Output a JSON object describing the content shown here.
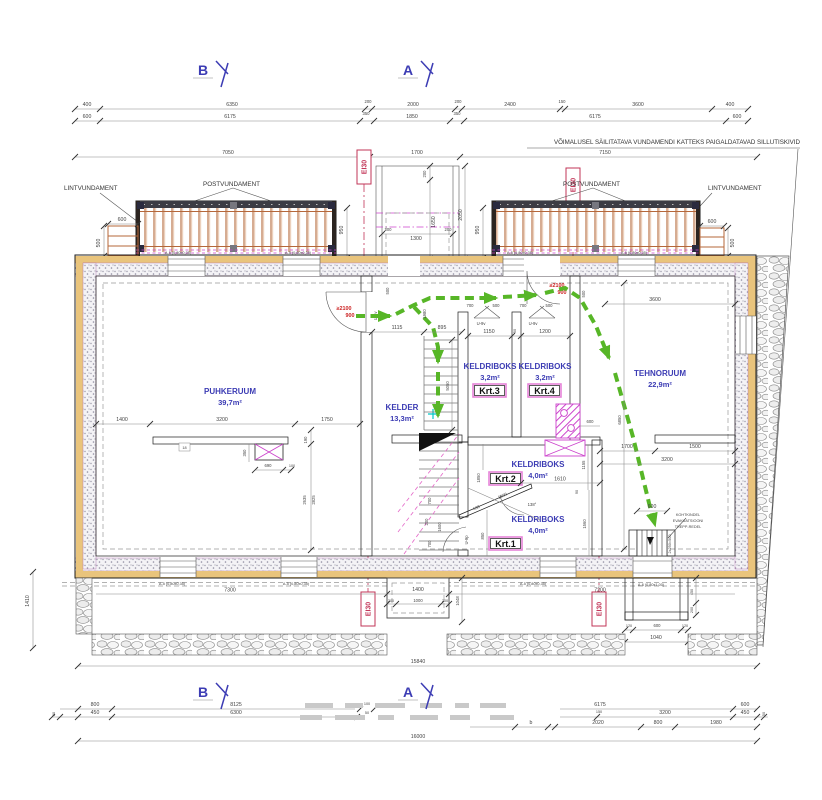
{
  "drawing": {
    "section_markers": {
      "b": "B",
      "a": "A"
    },
    "pavement_note": "VÕIMALUSEL SÄILITATAVA VUNDAMENDI KATTEKS PAIGALDATAVAD SILLUTISKIVID",
    "ladder_note_1": "KOHTKINDEL",
    "ladder_note_2": "EVAKUATSIOONI",
    "ladder_note_3": "TREPP-REDEL",
    "fire_rating": "EI30",
    "foundation": {
      "lint": "LINTVUNDAMENT",
      "post": "POSTVUNDAMENT"
    },
    "rooms": {
      "puhkeruum": {
        "name": "PUHKERUUM",
        "area": "39,7m²"
      },
      "kelder": {
        "name": "KELDER",
        "area": "13,3m²"
      },
      "krt3": {
        "name": "KELDRIBOKS",
        "area": "3,2m²",
        "unit": "Krt.3"
      },
      "krt4": {
        "name": "KELDRIBOKS",
        "area": "3,2m²",
        "unit": "Krt.4"
      },
      "tehnoruum": {
        "name": "TEHNORUUM",
        "area": "22,9m²"
      },
      "krt2": {
        "name": "KELDRIBOKS",
        "area": "4,0m²",
        "unit": "Krt.2"
      },
      "krt1": {
        "name": "KELDRIBOKS",
        "area": "4,0m²",
        "unit": "Krt.1"
      }
    },
    "openings": {
      "a5": "A-5 (0,80x0,35)",
      "a6": "A-6 (0,80x1,00)",
      "a4": "A-4 (0,80x0,60)",
      "u9v": "U-9v",
      "u9p": "U-9p",
      "u4v": "U-4v",
      "door_height": "≥2100",
      "door_width": "900",
      "ladder_rungs": "2x250=500"
    },
    "colors": {
      "escape_route_green": "#57b627",
      "fire_rating_red": "#c23457",
      "room_label_blue": "#3c3cb4",
      "services_magenta": "#cc44cc",
      "insulation_sand": "#e9c47c"
    },
    "dims": {
      "top1": [
        "400",
        "6350",
        "200",
        "2000",
        "200",
        "2400",
        "150",
        "3600",
        "400"
      ],
      "top2": [
        "600",
        "6175",
        "350",
        "1850",
        "350",
        "6175",
        "600"
      ],
      "top3": [
        "7050",
        "1700",
        "7150"
      ],
      "porch": [
        "200",
        "1650",
        "2050",
        "200",
        "1300",
        "200"
      ],
      "flank": [
        "950",
        "950"
      ],
      "step_left": [
        "600",
        "500"
      ],
      "step_right": [
        "600",
        "500"
      ],
      "puhkeruum_row": [
        "1400",
        "3200",
        "1750"
      ],
      "puhkeruum_misc": [
        "190",
        "2635",
        "2825",
        "350",
        "690",
        "100",
        "18"
      ],
      "corridor": [
        "500",
        "1115",
        "895",
        "1980",
        "5050",
        "1150",
        "50",
        "1200",
        "700",
        "500",
        "700",
        "500",
        "500"
      ],
      "krt": [
        "1850",
        "1610",
        "1155",
        "1900",
        "630",
        "138°",
        "700",
        "200",
        "1600",
        "700",
        "850",
        "90",
        "1560"
      ],
      "tehno": [
        "3600",
        "6850",
        "600",
        "1700",
        "1500",
        "3200"
      ],
      "ladder": [
        "600",
        "120",
        "600",
        "120",
        "1040",
        "450",
        "200"
      ],
      "well": [
        "1400",
        "200",
        "1000",
        "200",
        "1048"
      ],
      "inner_bottom": [
        "7300",
        "7200"
      ],
      "left_v": "1410",
      "mid_total": "15840",
      "bottom1": [
        "800",
        "8125",
        "100",
        "6175",
        "600"
      ],
      "bottom2": [
        "50",
        "450",
        "6300",
        "50",
        "150",
        "3200",
        "450",
        "50"
      ],
      "bottom3": [
        "2020",
        "800",
        "1980",
        "b"
      ],
      "total": "16000"
    }
  }
}
